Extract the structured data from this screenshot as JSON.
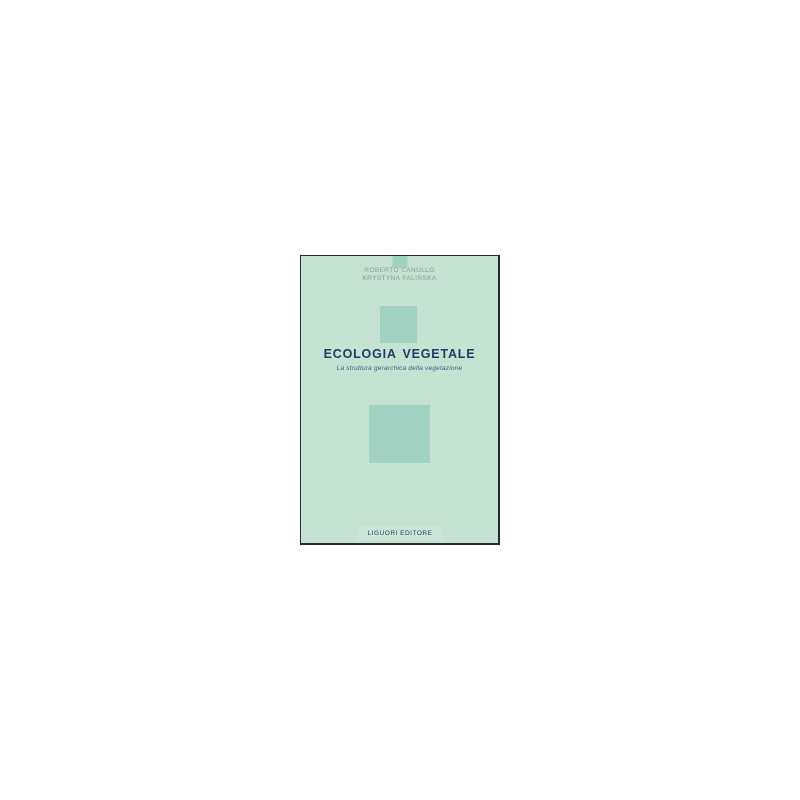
{
  "canvas": {
    "background_color": "#ffffff"
  },
  "book_cover": {
    "colors": {
      "cover_background": "#c5e2d2",
      "accent_squares": "#9fd2c0",
      "publisher_band": "#cbe6d7",
      "border": "#2a2a2a",
      "title_text": "#1e3e62",
      "subtitle_text": "#3e5e80",
      "authors_text": "#8a9c92"
    },
    "authors": [
      "ROBERTO CANULLO",
      "KRYSTYNA FALIŃSKA"
    ],
    "title": "ECOLOGIA VEGETALE",
    "subtitle": "La struttura gerarchica della vegetazione",
    "publisher": {
      "label": "LIGUORI EDITORE"
    }
  }
}
